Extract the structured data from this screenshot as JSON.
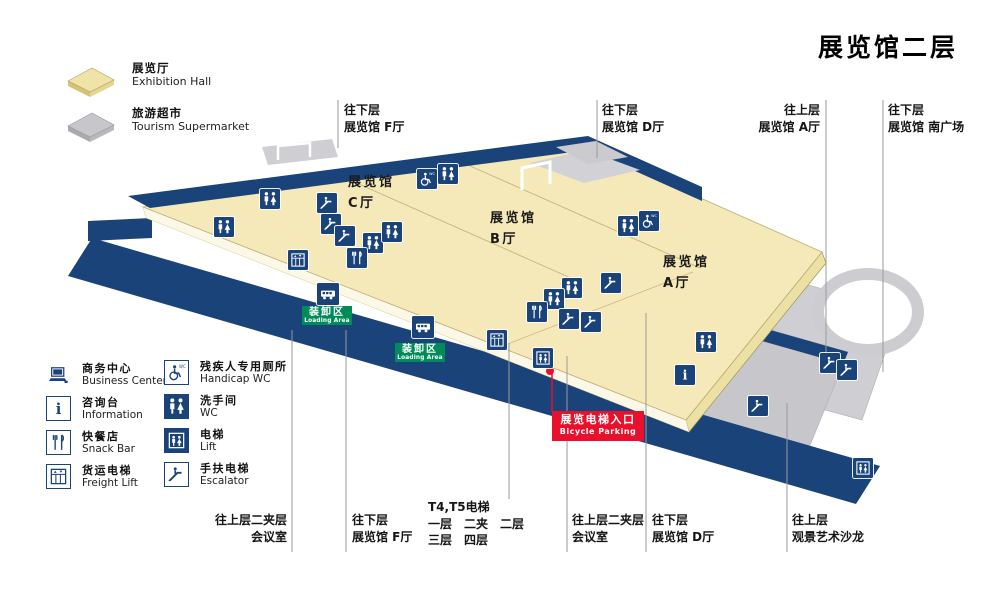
{
  "title": "展览馆二层",
  "colors": {
    "navy": "#1A4379",
    "floor": "#F5E9BA",
    "floor_edge": "#EDE0A4",
    "gray": "#CBCBCF",
    "green": "#008C5A",
    "red": "#E8112D",
    "leader_line": "#9a9a9a",
    "divider": "#C4B57E"
  },
  "legend_top": {
    "items": [
      {
        "zh": "展览厅",
        "en": "Exhibition Hall",
        "swatch": "yellow-tile"
      },
      {
        "zh": "旅游超市",
        "en": "Tourism Supermarket",
        "swatch": "gray-tile"
      }
    ]
  },
  "halls": [
    {
      "line1": "展览馆",
      "line2": "C厅",
      "x": 348,
      "y": 172
    },
    {
      "line1": "展览馆",
      "line2": "B厅",
      "x": 490,
      "y": 208
    },
    {
      "line1": "展览馆",
      "line2": "A厅",
      "x": 663,
      "y": 252
    }
  ],
  "top_callouts": [
    {
      "lines": [
        "往下层",
        "展览馆 F厅"
      ],
      "x": 344,
      "y": 102,
      "align": "left",
      "line_x": 338,
      "line_y1": 100,
      "line_y2": 148
    },
    {
      "lines": [
        "往下层",
        "展览馆 D厅"
      ],
      "x": 602,
      "y": 102,
      "align": "left",
      "line_x": 597,
      "line_y1": 100,
      "line_y2": 158
    },
    {
      "lines": [
        "往上层",
        "展览馆 A厅"
      ],
      "x": 820,
      "y": 102,
      "align": "right",
      "line_x": 826,
      "line_y1": 100,
      "line_y2": 352
    },
    {
      "lines": [
        "往下层",
        "展览馆 南广场"
      ],
      "x": 888,
      "y": 102,
      "align": "left",
      "line_x": 883,
      "line_y1": 100,
      "line_y2": 372
    }
  ],
  "bottom_callouts": [
    {
      "lines": [
        "往上层二夹层",
        "会议室"
      ],
      "x": 287,
      "y": 512,
      "align": "right",
      "line_x": 292,
      "line_y1": 330,
      "line_y2": 552
    },
    {
      "lines": [
        "往下层",
        "展览馆 F厅"
      ],
      "x": 352,
      "y": 512,
      "align": "left",
      "line_x": 346,
      "line_y1": 330,
      "line_y2": 552
    },
    {
      "lines": [
        "T4,T5电梯",
        "一层　二夹　二层",
        "三层　四层"
      ],
      "x": 428,
      "y": 499,
      "align": "left",
      "line_x": 509,
      "line_y1": 343,
      "line_y2": 499
    },
    {
      "lines": [
        "往上层二夹层",
        "会议室"
      ],
      "x": 572,
      "y": 512,
      "align": "left",
      "line_x": 567,
      "line_y1": 356,
      "line_y2": 552
    },
    {
      "lines": [
        "往下层",
        "展览馆 D厅"
      ],
      "x": 652,
      "y": 512,
      "align": "left",
      "line_x": 646,
      "line_y1": 313,
      "line_y2": 552
    },
    {
      "lines": [
        "往上层",
        "观景艺术沙龙"
      ],
      "x": 792,
      "y": 512,
      "align": "left",
      "line_x": 787,
      "line_y1": 403,
      "line_y2": 552
    }
  ],
  "loading_areas": [
    {
      "zh": "装卸区",
      "en": "Loading Area",
      "x": 302,
      "y": 306,
      "truck_x": 328,
      "truck_y": 294
    },
    {
      "zh": "装卸区",
      "en": "Loading Area",
      "x": 395,
      "y": 343,
      "truck_x": 423,
      "truck_y": 327
    }
  ],
  "entrance_callout": {
    "zh": "展览电梯入口",
    "en": "Bicycle Parking",
    "x": 552,
    "y": 411,
    "dot_x": 550,
    "dot_y": 371
  },
  "legend": {
    "left": [
      {
        "zh": "商务中心",
        "en": "Business Center",
        "icon": "computer"
      },
      {
        "zh": "咨询台",
        "en": "Information",
        "icon": "info"
      },
      {
        "zh": "快餐店",
        "en": "Snack Bar",
        "icon": "snack"
      },
      {
        "zh": "货运电梯",
        "en": "Freight Lift",
        "icon": "freight"
      }
    ],
    "right": [
      {
        "zh": "残疾人专用厕所",
        "en": "Handicap WC",
        "icon": "hcwc"
      },
      {
        "zh": "洗手间",
        "en": "WC",
        "icon": "wc"
      },
      {
        "zh": "电梯",
        "en": "Lift",
        "icon": "lift"
      },
      {
        "zh": "手扶电梯",
        "en": "Escalator",
        "icon": "esc"
      }
    ]
  },
  "markers": [
    {
      "type": "wc",
      "x": 270,
      "y": 199
    },
    {
      "type": "wc",
      "x": 224,
      "y": 227
    },
    {
      "type": "esc",
      "x": 327,
      "y": 203
    },
    {
      "type": "esc",
      "x": 331,
      "y": 224
    },
    {
      "type": "esc",
      "x": 345,
      "y": 236
    },
    {
      "type": "wc",
      "x": 373,
      "y": 243
    },
    {
      "type": "snack",
      "x": 357,
      "y": 258
    },
    {
      "type": "freight",
      "x": 298,
      "y": 260
    },
    {
      "type": "hcwc",
      "x": 427,
      "y": 179
    },
    {
      "type": "wc",
      "x": 448,
      "y": 174
    },
    {
      "type": "wc",
      "x": 392,
      "y": 232
    },
    {
      "type": "hcwc",
      "x": 649,
      "y": 221
    },
    {
      "type": "wc",
      "x": 628,
      "y": 226
    },
    {
      "type": "wc",
      "x": 572,
      "y": 288
    },
    {
      "type": "wc",
      "x": 554,
      "y": 299
    },
    {
      "type": "snack",
      "x": 537,
      "y": 312
    },
    {
      "type": "esc",
      "x": 611,
      "y": 283
    },
    {
      "type": "esc",
      "x": 569,
      "y": 319
    },
    {
      "type": "esc",
      "x": 591,
      "y": 322
    },
    {
      "type": "freight",
      "x": 497,
      "y": 340
    },
    {
      "type": "lift",
      "x": 543,
      "y": 358
    },
    {
      "type": "wc",
      "x": 706,
      "y": 342
    },
    {
      "type": "info",
      "x": 685,
      "y": 375
    },
    {
      "type": "esc",
      "x": 830,
      "y": 363
    },
    {
      "type": "esc",
      "x": 847,
      "y": 370
    },
    {
      "type": "esc",
      "x": 758,
      "y": 406
    },
    {
      "type": "lift",
      "x": 863,
      "y": 468
    }
  ]
}
